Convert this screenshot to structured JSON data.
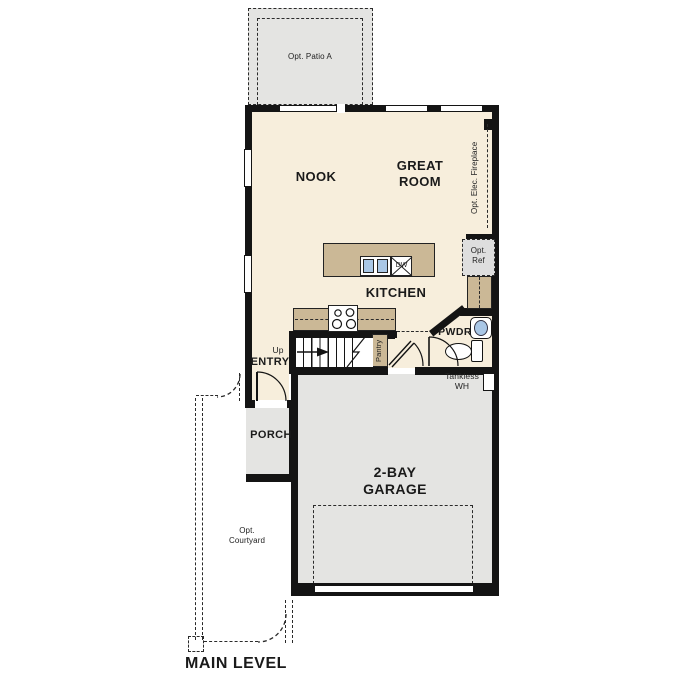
{
  "title": "MAIN LEVEL",
  "rooms": {
    "nook": "NOOK",
    "great1": "GREAT",
    "great2": "ROOM",
    "kitchen": "KITCHEN",
    "entry": "ENTRY",
    "porch": "PORCH",
    "pwdr": "PWDR",
    "garage1": "2-BAY",
    "garage2": "GARAGE",
    "pantry": "Pantry"
  },
  "annotations": {
    "patio": "Opt. Patio A",
    "fireplace": "Opt. Elec. Fireplace",
    "ref1": "Opt.",
    "ref2": "Ref",
    "court1": "Opt.",
    "court2": "Courtyard",
    "tank1": "Tankless",
    "tank2": "WH",
    "up": "Up",
    "dw": "DW"
  },
  "colors": {
    "cream": "#f7eedc",
    "tan": "#cbb896",
    "gray": "#e4e4e2",
    "wall": "#141414",
    "blue": "#a9c7e6",
    "refgray": "#dedede"
  }
}
